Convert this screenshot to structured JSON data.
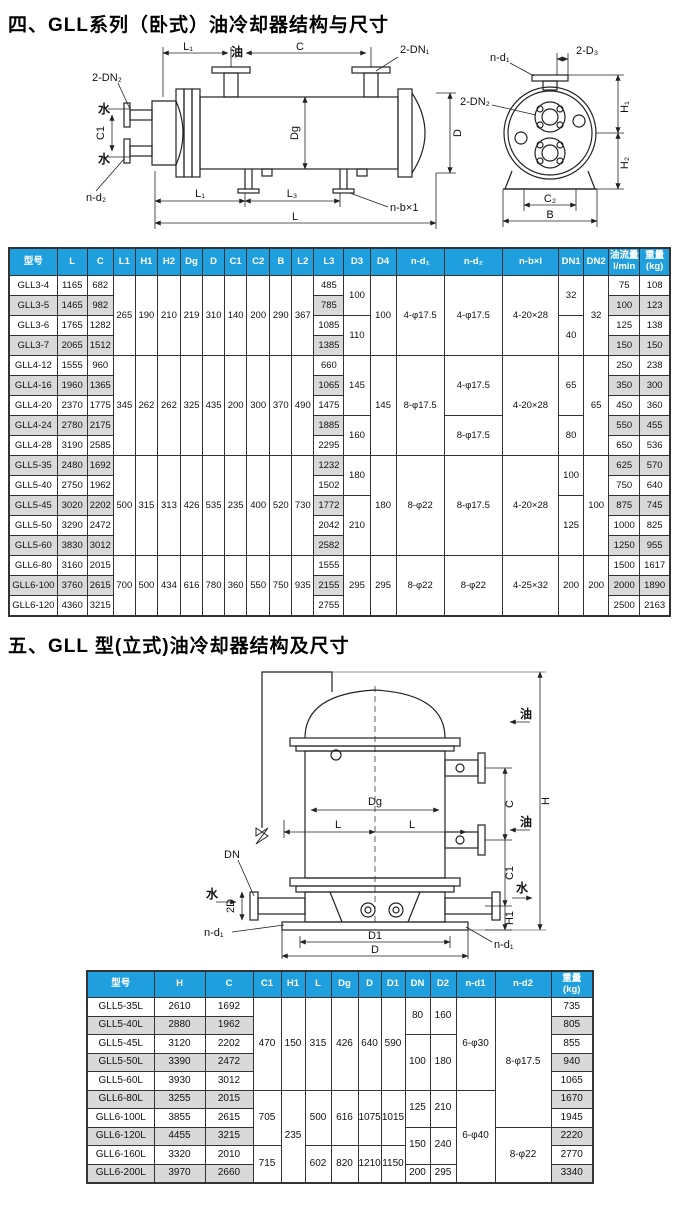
{
  "colors": {
    "header_bg": "#1f9fdd",
    "header_text": "#ffffff",
    "shade": "#d9d9d9",
    "line": "#222222"
  },
  "section1": {
    "title": "四、GLL系列（卧式）油冷却器结构与尺寸"
  },
  "section2": {
    "title": "五、GLL 型(立式)油冷却器结构及尺寸"
  },
  "diagram1": {
    "labels": {
      "l1_top": "L₁",
      "oil": "油",
      "c": "C",
      "dn1": "2-DN₁",
      "dn2": "2-DN₂",
      "water_top": "水",
      "c1": "C1",
      "water_bottom": "水",
      "nd2": "n-d₂",
      "dg": "Dg",
      "d": "D",
      "l1_bottom": "L₁",
      "l3": "L₃",
      "nbx1": "n-b×1",
      "l": "L",
      "end_nd1": "n-d₁",
      "end_2d3": "2-D₃",
      "end_dn2": "2-DN₂",
      "end_h1": "H₁",
      "end_h2": "H₂",
      "end_c2": "C₂",
      "end_b": "B"
    }
  },
  "diagram2": {
    "labels": {
      "oil_top": "油",
      "oil_mid": "油",
      "water_right": "水",
      "water_left": "水",
      "dg": "Dg",
      "l_left": "L",
      "l_right": "L",
      "c": "C",
      "h": "H",
      "dn": "DN",
      "two_d": "2D",
      "c1": "C1",
      "h1": "H1",
      "nd1_left": "n-d₁",
      "nd1_right": "n-d₁",
      "d1": "D1",
      "d": "D"
    }
  },
  "table1": {
    "headers": [
      "型号",
      "L",
      "C",
      "L1",
      "H1",
      "H2",
      "Dg",
      "D",
      "C1",
      "C2",
      "B",
      "L2",
      "L3",
      "D3",
      "D4",
      "n-d₁",
      "n-d₂",
      "n-b×l",
      "DN1",
      "DN2",
      "油流量\nl/min",
      "重量\n(kg)"
    ],
    "rows": [
      [
        {
          "t": "GLL3-4"
        },
        {
          "t": "1165"
        },
        {
          "t": "682"
        },
        {
          "t": "265",
          "rs": 4
        },
        {
          "t": "190",
          "rs": 4
        },
        {
          "t": "210",
          "rs": 4
        },
        {
          "t": "219",
          "rs": 4
        },
        {
          "t": "310",
          "rs": 4
        },
        {
          "t": "140",
          "rs": 4
        },
        {
          "t": "200",
          "rs": 4
        },
        {
          "t": "290",
          "rs": 4
        },
        {
          "t": "367",
          "rs": 4
        },
        {
          "t": "485"
        },
        {
          "t": "100",
          "rs": 2
        },
        {
          "t": "100",
          "rs": 4
        },
        {
          "t": "4-φ17.5",
          "rs": 4
        },
        {
          "t": "4-φ17.5",
          "rs": 4
        },
        {
          "t": "4-20×28",
          "rs": 4
        },
        {
          "t": "32",
          "rs": 2
        },
        {
          "t": "32",
          "rs": 4
        },
        {
          "t": "75"
        },
        {
          "t": "108"
        }
      ],
      [
        {
          "t": "GLL3-5",
          "s": 1
        },
        {
          "t": "1465",
          "s": 1
        },
        {
          "t": "982",
          "s": 1
        },
        {
          "t": "785",
          "s": 1
        },
        {
          "t": "100",
          "s": 1
        },
        {
          "t": "123",
          "s": 1
        }
      ],
      [
        {
          "t": "GLL3-6"
        },
        {
          "t": "1765"
        },
        {
          "t": "1282"
        },
        {
          "t": "1085"
        },
        {
          "t": "110",
          "rs": 2
        },
        {
          "t": "40",
          "rs": 2
        },
        {
          "t": "125"
        },
        {
          "t": "138"
        }
      ],
      [
        {
          "t": "GLL3-7",
          "s": 1
        },
        {
          "t": "2065",
          "s": 1
        },
        {
          "t": "1512",
          "s": 1
        },
        {
          "t": "1385",
          "s": 1
        },
        {
          "t": "150",
          "s": 1
        },
        {
          "t": "150",
          "s": 1
        }
      ],
      [
        {
          "t": "GLL4-12"
        },
        {
          "t": "1555"
        },
        {
          "t": "960"
        },
        {
          "t": "345",
          "rs": 5
        },
        {
          "t": "262",
          "rs": 5
        },
        {
          "t": "262",
          "rs": 5
        },
        {
          "t": "325",
          "rs": 5
        },
        {
          "t": "435",
          "rs": 5
        },
        {
          "t": "200",
          "rs": 5
        },
        {
          "t": "300",
          "rs": 5
        },
        {
          "t": "370",
          "rs": 5
        },
        {
          "t": "490",
          "rs": 5
        },
        {
          "t": "660"
        },
        {
          "t": "145",
          "rs": 3
        },
        {
          "t": "145",
          "rs": 5
        },
        {
          "t": "8-φ17.5",
          "rs": 5
        },
        {
          "t": "4-φ17.5",
          "rs": 3
        },
        {
          "t": "4-20×28",
          "rs": 5
        },
        {
          "t": "65",
          "rs": 3
        },
        {
          "t": "65",
          "rs": 5
        },
        {
          "t": "250"
        },
        {
          "t": "238"
        }
      ],
      [
        {
          "t": "GLL4-16",
          "s": 1
        },
        {
          "t": "1960",
          "s": 1
        },
        {
          "t": "1365",
          "s": 1
        },
        {
          "t": "1065",
          "s": 1
        },
        {
          "t": "350",
          "s": 1
        },
        {
          "t": "300",
          "s": 1
        }
      ],
      [
        {
          "t": "GLL4-20"
        },
        {
          "t": "2370"
        },
        {
          "t": "1775"
        },
        {
          "t": "1475"
        },
        {
          "t": "450"
        },
        {
          "t": "360"
        }
      ],
      [
        {
          "t": "GLL4-24",
          "s": 1
        },
        {
          "t": "2780",
          "s": 1
        },
        {
          "t": "2175",
          "s": 1
        },
        {
          "t": "1885",
          "s": 1
        },
        {
          "t": "160",
          "rs": 2
        },
        {
          "t": "8-φ17.5",
          "rs": 2
        },
        {
          "t": "80",
          "rs": 2
        },
        {
          "t": "550",
          "s": 1
        },
        {
          "t": "455",
          "s": 1
        }
      ],
      [
        {
          "t": "GLL4-28"
        },
        {
          "t": "3190"
        },
        {
          "t": "2585"
        },
        {
          "t": "2295"
        },
        {
          "t": "650"
        },
        {
          "t": "536"
        }
      ],
      [
        {
          "t": "GLL5-35",
          "s": 1
        },
        {
          "t": "2480",
          "s": 1
        },
        {
          "t": "1692",
          "s": 1
        },
        {
          "t": "500",
          "rs": 5
        },
        {
          "t": "315",
          "rs": 5
        },
        {
          "t": "313",
          "rs": 5
        },
        {
          "t": "426",
          "rs": 5
        },
        {
          "t": "535",
          "rs": 5
        },
        {
          "t": "235",
          "rs": 5
        },
        {
          "t": "400",
          "rs": 5
        },
        {
          "t": "520",
          "rs": 5
        },
        {
          "t": "730",
          "rs": 5
        },
        {
          "t": "1232",
          "s": 1
        },
        {
          "t": "180",
          "rs": 2
        },
        {
          "t": "180",
          "rs": 5
        },
        {
          "t": "8-φ22",
          "rs": 5
        },
        {
          "t": "8-φ17.5",
          "rs": 5
        },
        {
          "t": "4-20×28",
          "rs": 5
        },
        {
          "t": "100",
          "rs": 2
        },
        {
          "t": "100",
          "rs": 5
        },
        {
          "t": "625",
          "s": 1
        },
        {
          "t": "570",
          "s": 1
        }
      ],
      [
        {
          "t": "GLL5-40"
        },
        {
          "t": "2750"
        },
        {
          "t": "1962"
        },
        {
          "t": "1502"
        },
        {
          "t": "750"
        },
        {
          "t": "640"
        }
      ],
      [
        {
          "t": "GLL5-45",
          "s": 1
        },
        {
          "t": "3020",
          "s": 1
        },
        {
          "t": "2202",
          "s": 1
        },
        {
          "t": "1772",
          "s": 1
        },
        {
          "t": "210",
          "rs": 3
        },
        {
          "t": "125",
          "rs": 3
        },
        {
          "t": "875",
          "s": 1
        },
        {
          "t": "745",
          "s": 1
        }
      ],
      [
        {
          "t": "GLL5-50"
        },
        {
          "t": "3290"
        },
        {
          "t": "2472"
        },
        {
          "t": "2042"
        },
        {
          "t": "1000"
        },
        {
          "t": "825"
        }
      ],
      [
        {
          "t": "GLL5-60",
          "s": 1
        },
        {
          "t": "3830",
          "s": 1
        },
        {
          "t": "3012",
          "s": 1
        },
        {
          "t": "2582",
          "s": 1
        },
        {
          "t": "1250",
          "s": 1
        },
        {
          "t": "955",
          "s": 1
        }
      ],
      [
        {
          "t": "GLL6-80"
        },
        {
          "t": "3160"
        },
        {
          "t": "2015"
        },
        {
          "t": "700",
          "rs": 3
        },
        {
          "t": "500",
          "rs": 3
        },
        {
          "t": "434",
          "rs": 3
        },
        {
          "t": "616",
          "rs": 3
        },
        {
          "t": "780",
          "rs": 3
        },
        {
          "t": "360",
          "rs": 3
        },
        {
          "t": "550",
          "rs": 3
        },
        {
          "t": "750",
          "rs": 3
        },
        {
          "t": "935",
          "rs": 3
        },
        {
          "t": "1555"
        },
        {
          "t": "295",
          "rs": 3
        },
        {
          "t": "295",
          "rs": 3
        },
        {
          "t": "8-φ22",
          "rs": 3
        },
        {
          "t": "8-φ22",
          "rs": 3
        },
        {
          "t": "4-25×32",
          "rs": 3
        },
        {
          "t": "200",
          "rs": 3
        },
        {
          "t": "200",
          "rs": 3
        },
        {
          "t": "1500"
        },
        {
          "t": "1617"
        }
      ],
      [
        {
          "t": "GLL6-100",
          "s": 1
        },
        {
          "t": "3760",
          "s": 1
        },
        {
          "t": "2615",
          "s": 1
        },
        {
          "t": "2155",
          "s": 1
        },
        {
          "t": "2000",
          "s": 1
        },
        {
          "t": "1890",
          "s": 1
        }
      ],
      [
        {
          "t": "GLL6-120"
        },
        {
          "t": "4360"
        },
        {
          "t": "3215"
        },
        {
          "t": "2755"
        },
        {
          "t": "2500"
        },
        {
          "t": "2163"
        }
      ]
    ]
  },
  "table2": {
    "headers": [
      "型号",
      "H",
      "C",
      "C1",
      "H1",
      "L",
      "Dg",
      "D",
      "D1",
      "DN",
      "D2",
      "n-d1",
      "n-d2",
      "重量\n(kg)"
    ],
    "rows": [
      [
        {
          "t": "GLL5-35L"
        },
        {
          "t": "2610"
        },
        {
          "t": "1692"
        },
        {
          "t": "470",
          "rs": 5
        },
        {
          "t": "150",
          "rs": 5
        },
        {
          "t": "315",
          "rs": 5
        },
        {
          "t": "426",
          "rs": 5
        },
        {
          "t": "640",
          "rs": 5
        },
        {
          "t": "590",
          "rs": 5
        },
        {
          "t": "80",
          "rs": 2
        },
        {
          "t": "160",
          "rs": 2
        },
        {
          "t": "6-φ30",
          "rs": 5
        },
        {
          "t": "8-φ17.5",
          "rs": 7
        },
        {
          "t": "735"
        }
      ],
      [
        {
          "t": "GLL5-40L",
          "s": 1
        },
        {
          "t": "2880",
          "s": 1
        },
        {
          "t": "1962",
          "s": 1
        },
        {
          "t": "805",
          "s": 1
        }
      ],
      [
        {
          "t": "GLL5-45L"
        },
        {
          "t": "3120"
        },
        {
          "t": "2202"
        },
        {
          "t": "100",
          "rs": 3
        },
        {
          "t": "180",
          "rs": 3
        },
        {
          "t": "855"
        }
      ],
      [
        {
          "t": "GLL5-50L",
          "s": 1
        },
        {
          "t": "3390",
          "s": 1
        },
        {
          "t": "2472",
          "s": 1
        },
        {
          "t": "940",
          "s": 1
        }
      ],
      [
        {
          "t": "GLL5-60L"
        },
        {
          "t": "3930"
        },
        {
          "t": "3012"
        },
        {
          "t": "1065"
        }
      ],
      [
        {
          "t": "GLL6-80L",
          "s": 1
        },
        {
          "t": "3255",
          "s": 1
        },
        {
          "t": "2015",
          "s": 1
        },
        {
          "t": "705",
          "rs": 3
        },
        {
          "t": "235",
          "rs": 5
        },
        {
          "t": "500",
          "rs": 3
        },
        {
          "t": "616",
          "rs": 3
        },
        {
          "t": "1075",
          "rs": 3
        },
        {
          "t": "1015",
          "rs": 3
        },
        {
          "t": "125",
          "rs": 2
        },
        {
          "t": "210",
          "rs": 2
        },
        {
          "t": "6-φ40",
          "rs": 5
        },
        {
          "t": "1670",
          "s": 1
        }
      ],
      [
        {
          "t": "GLL6-100L"
        },
        {
          "t": "3855"
        },
        {
          "t": "2615"
        },
        {
          "t": "1945"
        }
      ],
      [
        {
          "t": "GLL6-120L",
          "s": 1
        },
        {
          "t": "4455",
          "s": 1
        },
        {
          "t": "3215",
          "s": 1
        },
        {
          "t": "150",
          "rs": 2
        },
        {
          "t": "240",
          "rs": 2
        },
        {
          "t": "8-φ22",
          "rs": 3
        },
        {
          "t": "2220",
          "s": 1
        }
      ],
      [
        {
          "t": "GLL6-160L"
        },
        {
          "t": "3320"
        },
        {
          "t": "2010"
        },
        {
          "t": "715",
          "rs": 2
        },
        {
          "t": "602",
          "rs": 2
        },
        {
          "t": "820",
          "rs": 2
        },
        {
          "t": "1210",
          "rs": 2
        },
        {
          "t": "1150",
          "rs": 2
        },
        {
          "t": "2770"
        }
      ],
      [
        {
          "t": "GLL6-200L",
          "s": 1
        },
        {
          "t": "3970",
          "s": 1
        },
        {
          "t": "2660",
          "s": 1
        },
        {
          "t": "200"
        },
        {
          "t": "295"
        },
        {
          "t": "3340",
          "s": 1
        }
      ]
    ]
  }
}
